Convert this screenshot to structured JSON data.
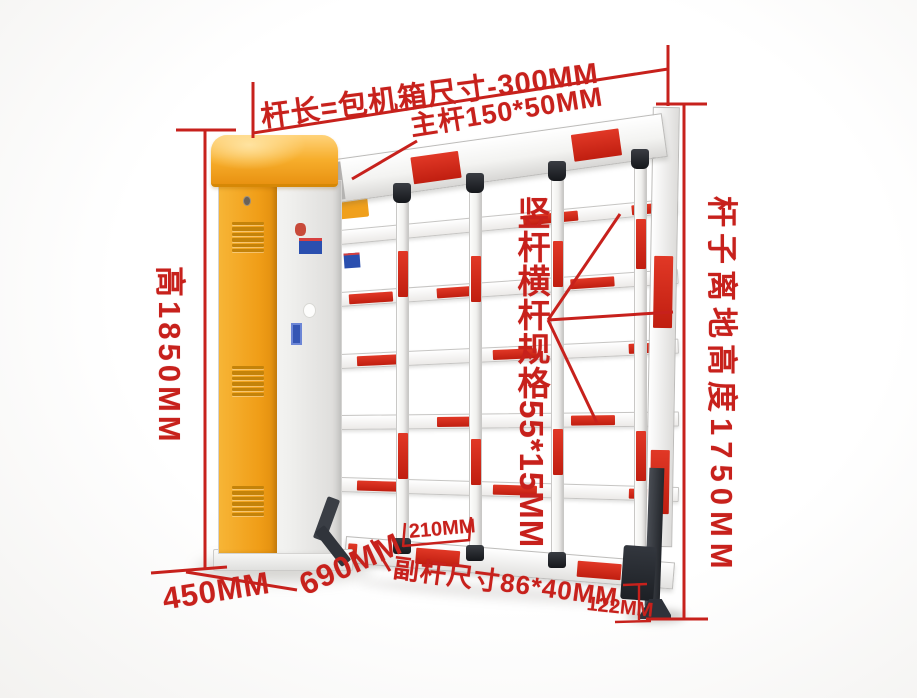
{
  "annotations": {
    "arm_length_label": "杆长=包机箱尺寸-300MM",
    "main_arm_label": "主杆150*50MM",
    "height_label": "高1850MM",
    "clearance_label": "杆子离地高度1750MM",
    "grid_spec_label": "竖杆横杆规格55*15MM",
    "spacing_label": "210MM",
    "base_width_label": "450MM",
    "base_depth_label": "690MM",
    "sub_arm_label": "副杆尺寸86*40MM",
    "ground_gap_label": "122MM"
  },
  "colors": {
    "annotation_red": "#c7211c",
    "reflective_red": "#d02a1c",
    "cabinet_orange": "#f3a41f",
    "bar_white": "#f5f5f3",
    "hardware_dark": "#33373d"
  }
}
